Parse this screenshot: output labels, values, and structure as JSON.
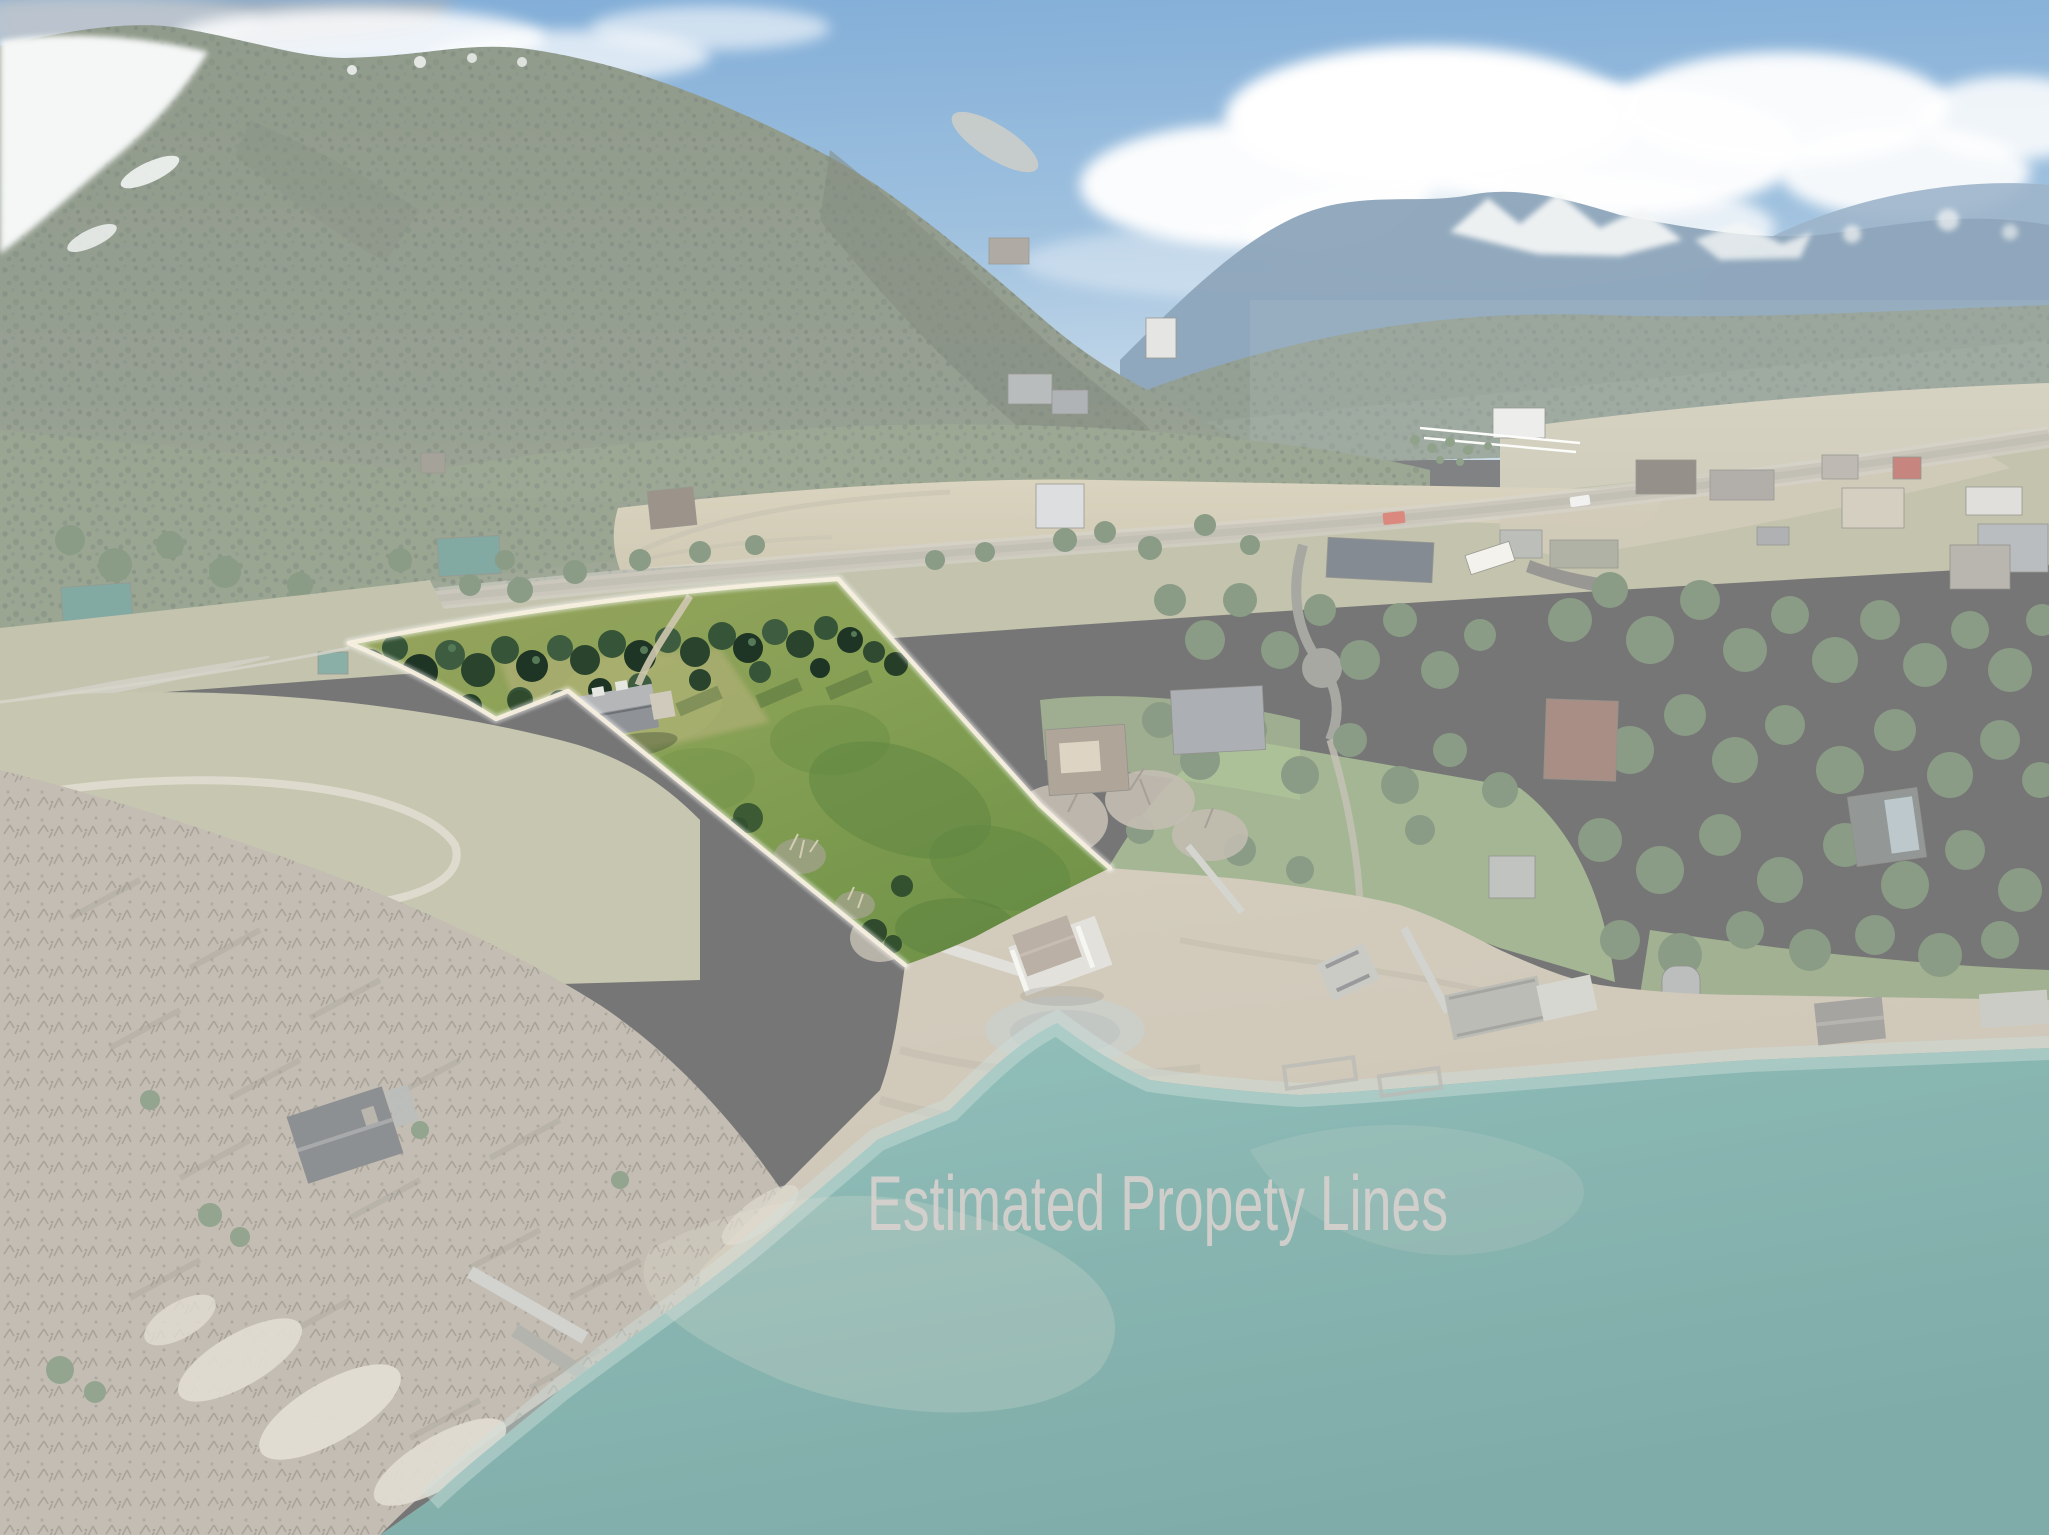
{
  "image": {
    "kind": "aerial-drone-photograph",
    "scene": "lakefront acreage listing photo: forested mountains, rural highway, highlighted parcel with cream boundary lines, gravel drawdown beach with docks, turquoise lake"
  },
  "watermark": {
    "label": "Estimated Propety Lines",
    "color": "#d7d1ce"
  },
  "palette": {
    "sky_top": "#2e77bd",
    "sky_horizon": "#a9c6de",
    "cloud": "#ffffff",
    "distant_ridge": "#446b8e",
    "snow": "#eef1f0",
    "mountain_forest": "#4a5d45",
    "mountain_speckle": "#2c3f2e",
    "tan_field": "#bcb191",
    "road": "#a8a291",
    "washed_meadow": "#9b9b78",
    "parcel_grass": "#7e9b4e",
    "parcel_trees": "#2a432d",
    "outline_line": "#f7efdf",
    "beach": "#b3a78f",
    "rock_slab": "#cfc8b6",
    "lake_shallow": "#4f9a92",
    "lake_deep": "#2a746f",
    "boathouse_roof": "#8d7c6c",
    "wash_overlay": "rgba(255,255,255,0.40)"
  },
  "features": {
    "parcel": "highlighted property parcel",
    "boathouse": "covered boat dock at parcel shoreline",
    "cabin": "a-frame cabin in bare woodland",
    "highway": "two-lane rural highway",
    "farmhouse": "white farmhouse with fenced yard"
  }
}
